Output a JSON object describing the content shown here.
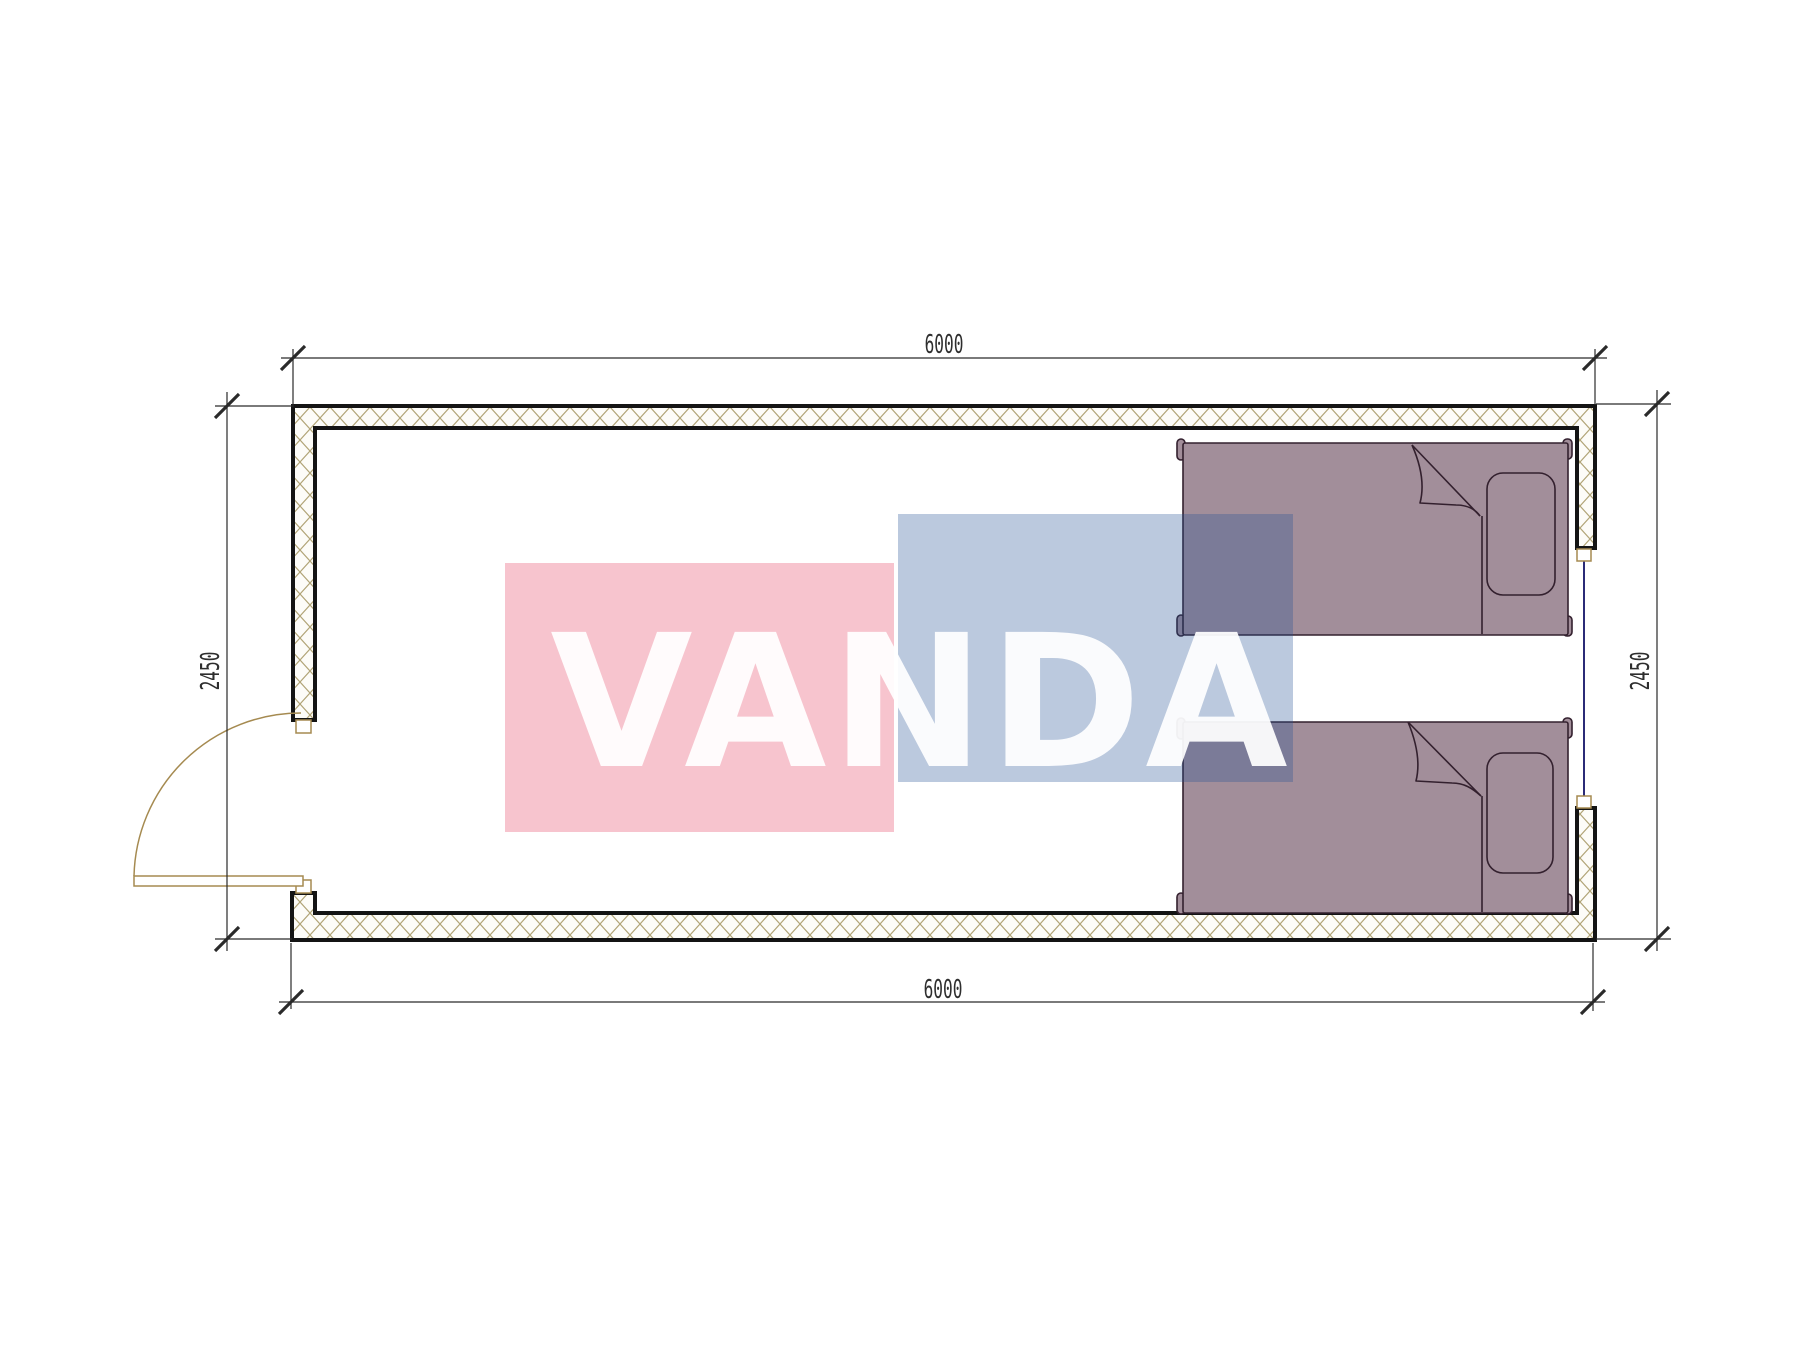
{
  "page": {
    "background": "#ffffff",
    "title": "container-module-floor-plan"
  },
  "watermark": {
    "text": "VANDA",
    "pink_fill": "rgba(229,63,98,0.31)",
    "blue_fill": "rgba(34,82,147,0.31)",
    "text_fill": "rgba(255,255,255,0.93)"
  },
  "dimensions": {
    "top": "6000",
    "bottom": "6000",
    "left": "2450",
    "right": "2450"
  },
  "plan": {
    "wall_stroke": "#141414",
    "hatch_stroke": "#b1a476",
    "bed_fill": "#a28e9a",
    "bed_stroke": "#33202e",
    "door_stroke": "#a58a50",
    "window_stroke": "#2b2b77",
    "dim_stroke": "#2a2a2a",
    "dim_text_color": "#2e2e2e",
    "elements": [
      "exterior-walls",
      "entry-door",
      "window",
      "bed-1",
      "bed-2"
    ]
  }
}
